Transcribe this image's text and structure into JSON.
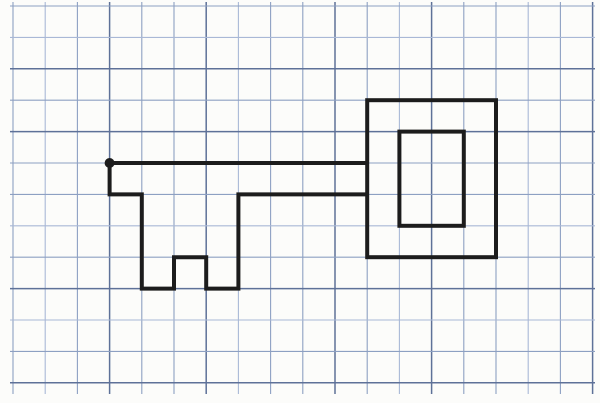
{
  "figure": {
    "kind": "key-outline-drawn-on-graph-paper",
    "paper_color": "#fcfcfa",
    "ink_color": "#1c1c1c",
    "grid": {
      "origin_x": 13,
      "origin_y": 6,
      "cell_width": 32.2,
      "cell_height": 31.4,
      "columns": 19,
      "rows": 13,
      "vline_top": 2,
      "vline_bottom": 394,
      "hline_left": 10,
      "hline_right": 595,
      "tone_colors": [
        "#8da0c2",
        "#a9b8d6",
        "#5e7198"
      ],
      "v_tones": [
        0,
        1,
        0,
        2,
        0,
        0,
        2,
        1,
        0,
        0,
        2,
        0,
        1,
        2,
        0,
        0,
        1,
        0,
        2
      ],
      "h_tones": [
        0,
        1,
        2,
        0,
        2,
        0,
        0,
        1,
        0,
        2,
        1,
        0,
        2
      ],
      "v_width_normal": 1.1,
      "v_width_dark": 1.5,
      "h_width_normal": 1.1,
      "h_width_dark": 1.5
    },
    "key": {
      "stroke_width": 4,
      "shaft_teeth_path": [
        [
          11,
          5
        ],
        [
          3,
          5
        ],
        [
          3,
          6
        ],
        [
          4,
          6
        ],
        [
          4,
          9
        ],
        [
          5,
          9
        ],
        [
          5,
          8
        ],
        [
          6,
          8
        ],
        [
          6,
          9
        ],
        [
          7,
          9
        ],
        [
          7,
          6
        ],
        [
          11,
          6
        ]
      ],
      "bow_outer": {
        "col": 11,
        "row": 3,
        "cols": 4,
        "rows": 5
      },
      "bow_inner": {
        "col": 12,
        "row": 4,
        "cols": 2,
        "rows": 3
      },
      "start_dot": {
        "col": 3,
        "row": 5,
        "radius": 5
      }
    }
  }
}
